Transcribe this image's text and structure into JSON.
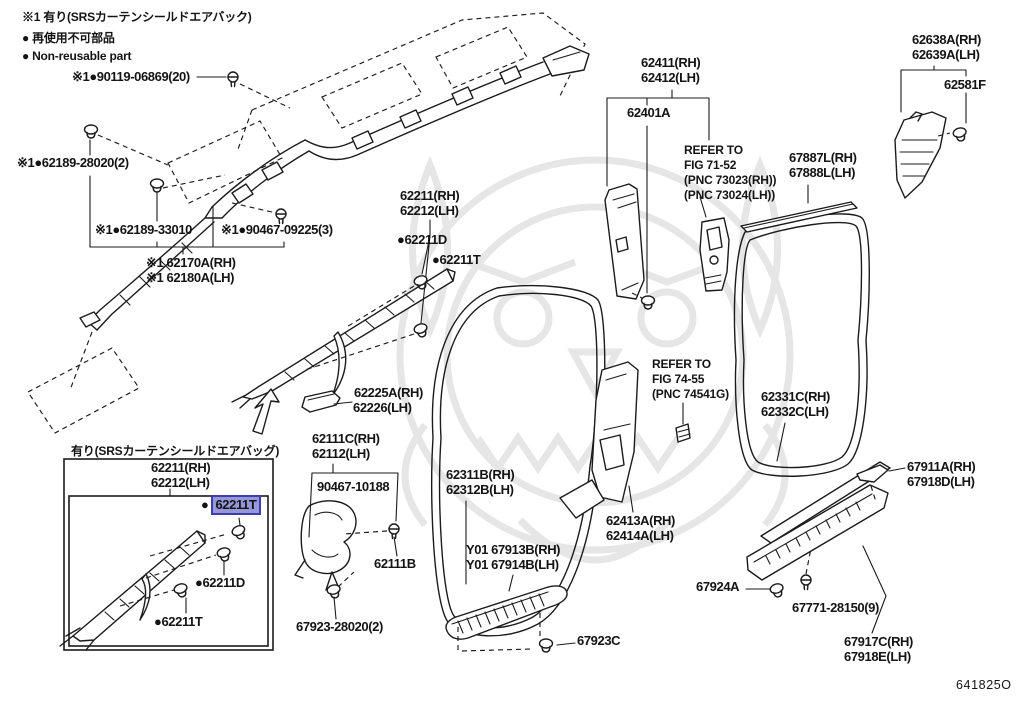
{
  "legend": {
    "line1": "※1 有り(SRSカーテンシールドエアバック)",
    "line2": "再使用不可部品",
    "line3": "Non-reusable part"
  },
  "glyphs": {
    "bullet": "●"
  },
  "callouts": {
    "p90119": "※1●90119-06869(20)",
    "p62189_28020": "※1●62189-28020(2)",
    "p62189_33010": "※1●62189-33010",
    "p90467_09225": "※1●90467-09225(3)",
    "p62170A": "※1 62170A(RH)",
    "p62180A": "※1 62180A(LH)",
    "p62211": "62211(RH)",
    "p62212": "62212(LH)",
    "p62211D": "●62211D",
    "p62211T": "●62211T",
    "p62225A": "62225A(RH)",
    "p62226": "62226(LH)",
    "p62111C": "62111C(RH)",
    "p62112": "62112(LH)",
    "p90467_10188": "90467-10188",
    "p62311B": "62311B(RH)",
    "p62312B": "62312B(LH)",
    "p62111B": "62111B",
    "p67923_28020": "67923-28020(2)",
    "pY01_67913B": "Y01 67913B(RH)",
    "pY01_67914B": "Y01 67914B(LH)",
    "p67923C": "67923C",
    "p62411": "62411(RH)",
    "p62412": "62412(LH)",
    "p62401A": "62401A",
    "p67887L": "67887L(RH)",
    "p67888L": "67888L(LH)",
    "p62638A": "62638A(RH)",
    "p62639A": "62639A(LH)",
    "p62581F": "62581F",
    "p62331C": "62331C(RH)",
    "p62332C": "62332C(LH)",
    "p62413A": "62413A(RH)",
    "p62414A": "62414A(LH)",
    "p67924A": "67924A",
    "p67771": "67771-28150(9)",
    "p67917C": "67917C(RH)",
    "p67918E": "67918E(LH)",
    "p67911A": "67911A(RH)",
    "p67918D": "67918D(LH)"
  },
  "refer1": {
    "l1": "REFER TO",
    "l2": "FIG 71-52",
    "l3": "(PNC 73023(RH))",
    "l4": "(PNC 73024(LH))"
  },
  "refer2": {
    "l1": "REFER TO",
    "l2": "FIG 74-55",
    "l3": "(PNC 74541G)"
  },
  "inset": {
    "title": "有り(SRSカーテンシールドエアバッグ)",
    "p62211": "62211(RH)",
    "p62212": "62212(LH)",
    "p62211T_top": "62211T",
    "p62211D": "●62211D",
    "p62211T_bottom": "●62211T"
  },
  "meta": {
    "diagram_code": "641825O"
  },
  "colors": {
    "highlight_fill": "#9697d8",
    "highlight_border": "#3d3db0",
    "line": "#1b1b1b",
    "watermark": "#e6e6e6"
  }
}
